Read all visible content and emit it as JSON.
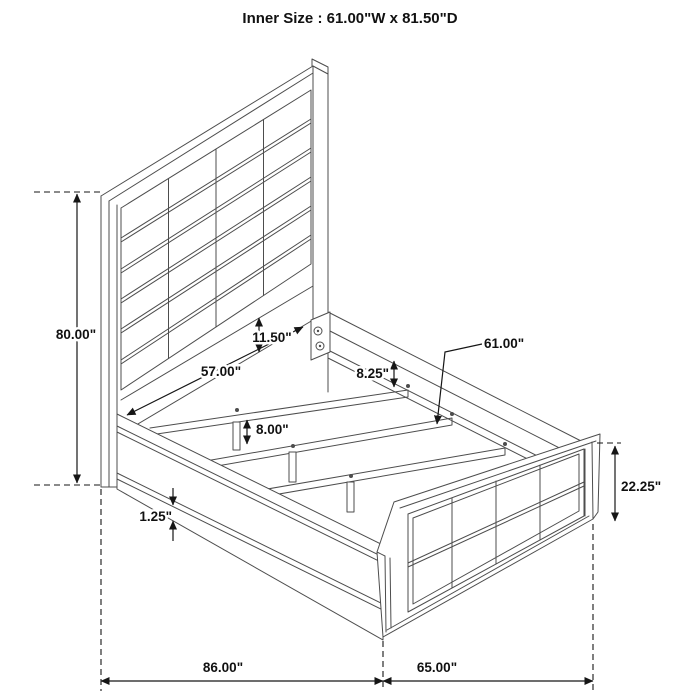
{
  "title": "Inner Size : 61.00\"W x 81.50\"D",
  "dimensions": {
    "headboard_height": "80.00\"",
    "headboard_width": "57.00\"",
    "headboard_rail_height": "11.50\"",
    "rail_to_slat_drop": "8.25\"",
    "slat_length": "61.00\"",
    "center_leg_height": "8.00\"",
    "side_rail_trim": "1.25\"",
    "footboard_height": "22.25\"",
    "overall_depth": "86.00\"",
    "overall_width": "65.00\""
  },
  "colors": {
    "line": "#4d4d4d",
    "annotation": "#161616",
    "background": "#ffffff"
  }
}
